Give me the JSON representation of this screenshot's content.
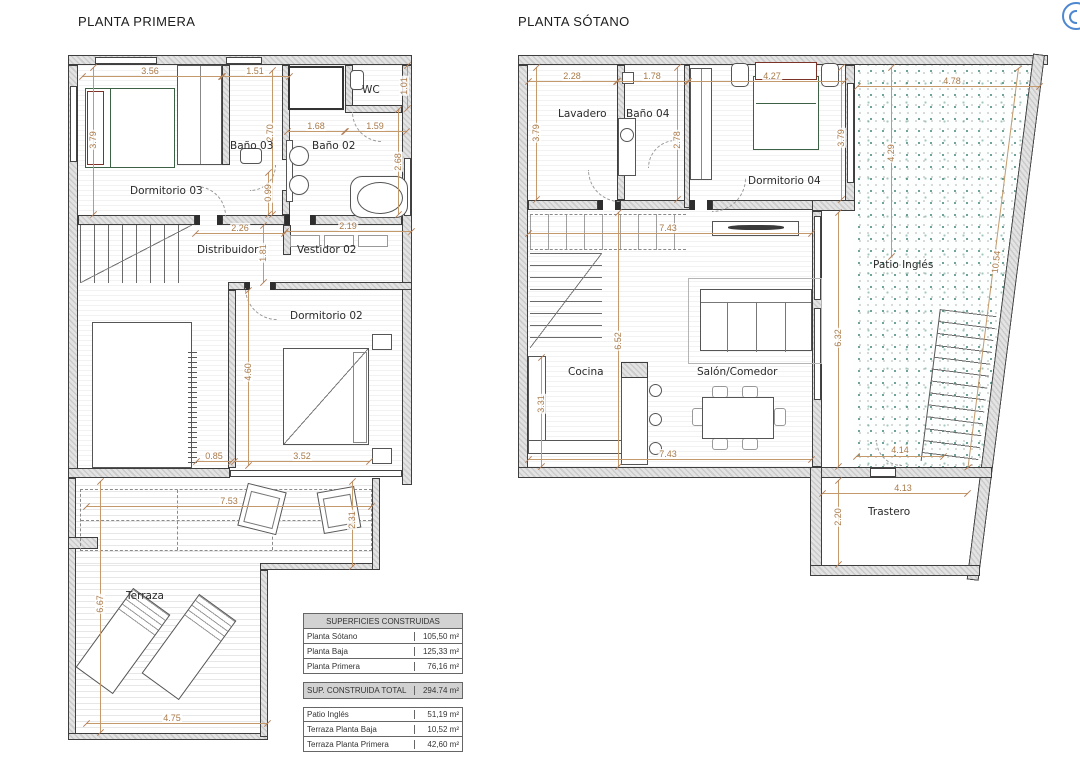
{
  "plan_primera": {
    "title": "PLANTA PRIMERA",
    "rooms": {
      "dormitorio03": "Dormitorio 03",
      "bano03": "Baño 03",
      "bano02": "Baño 02",
      "wc": "WC",
      "distribuidor": "Distribuidor",
      "vestidor02": "Vestidor 02",
      "dormitorio02": "Dormitorio 02",
      "terraza": "Terraza"
    },
    "dims": {
      "d1": "3.56",
      "d2": "1.51",
      "d3": "1.01",
      "d4": "2.70",
      "d5": "1.68",
      "d6": "1.59",
      "d7": "2.68",
      "d8": "3.79",
      "d9": "0.99",
      "d10": "2.26",
      "d11": "2.19",
      "d12": "1.81",
      "d13": "4.60",
      "d14": "0.85",
      "d15": "3.52",
      "d16": "7.53",
      "d17": "2.31",
      "d18": "6.67",
      "d19": "4.75"
    }
  },
  "plan_sotano": {
    "title": "PLANTA SÓTANO",
    "rooms": {
      "lavadero": "Lavadero",
      "bano04": "Baño 04",
      "dormitorio04": "Dormitorio 04",
      "patio": "Patio Inglés",
      "cocina": "Cocina",
      "salon": "Salón/Comedor",
      "trastero": "Trastero"
    },
    "dims": {
      "s1": "2.28",
      "s2": "1.78",
      "s3": "4.27",
      "s4": "4.78",
      "s5": "3.79",
      "s6": "2.78",
      "s7": "3.79",
      "s8": "4.29",
      "s9": "7.43",
      "s10": "10.54",
      "s11": "6.52",
      "s12": "3.31",
      "s13": "7.43",
      "s14": "6.32",
      "s15": "4.14",
      "s16": "4.13",
      "s17": "2.20"
    }
  },
  "summary_table": {
    "header": "SUPERFICIES CONSTRUIDAS",
    "rows": [
      {
        "label": "Planta Sótano",
        "value": "105,50 m²"
      },
      {
        "label": "Planta Baja",
        "value": "125,33 m²"
      },
      {
        "label": "Planta Primera",
        "value": "76,16 m²"
      }
    ],
    "total_label": "SUP. CONSTRUIDA TOTAL",
    "total_value": "294.74 m²",
    "extras": [
      {
        "label": "Patio Inglés",
        "value": "51,19 m²"
      },
      {
        "label": "Terraza Planta Baja",
        "value": "10,52 m²"
      },
      {
        "label": "Terraza Planta Primera",
        "value": "42,60 m²"
      }
    ]
  },
  "colors": {
    "dimension_text": "#a97a4a",
    "dimension_line": "#c49a6c",
    "wall_fill": "#d9d9d9",
    "patio_dot": "#5f9e92",
    "bed_blanket": "#3c6144",
    "bed_pillow": "#7a3326",
    "logo_blue": "#4d87cf"
  }
}
